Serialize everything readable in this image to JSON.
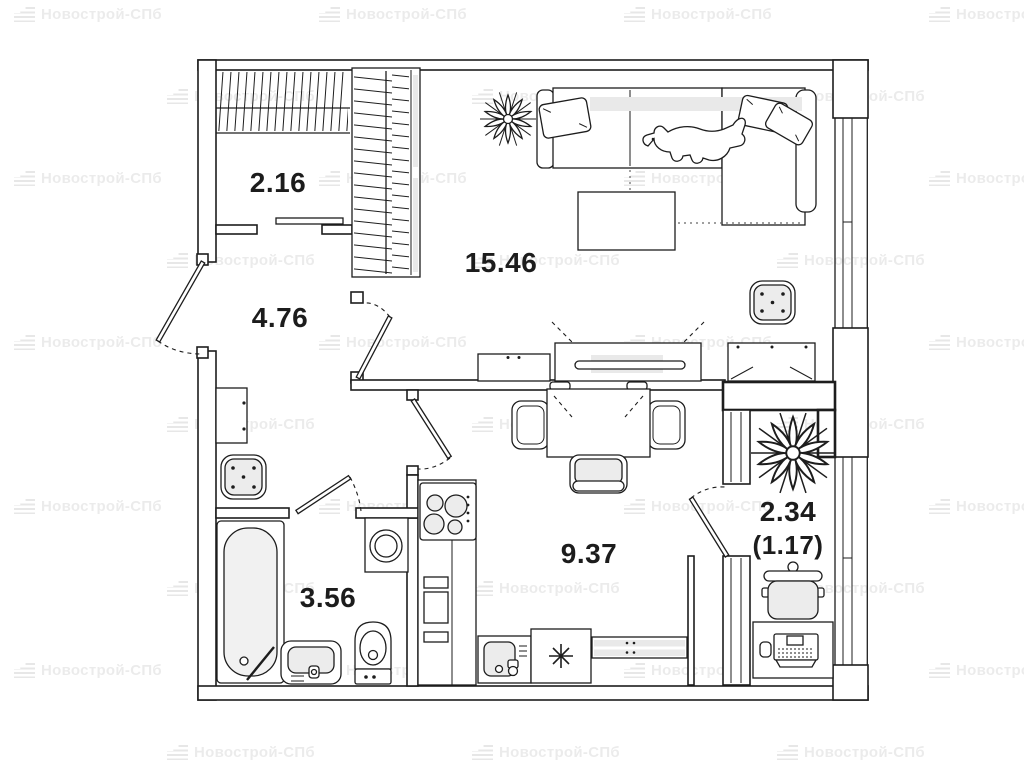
{
  "watermark": {
    "text": "Новострой-СПб"
  },
  "floorplan": {
    "rooms": [
      {
        "name": "closet",
        "area_m2": "2.16"
      },
      {
        "name": "hallway",
        "area_m2": "4.76"
      },
      {
        "name": "living-room",
        "area_m2": "15.46"
      },
      {
        "name": "bathroom",
        "area_m2": "3.56"
      },
      {
        "name": "kitchen",
        "area_m2": "9.37"
      },
      {
        "name": "balcony",
        "area_m2": "2.34",
        "area_reduced_m2": "(1.17)"
      }
    ]
  }
}
